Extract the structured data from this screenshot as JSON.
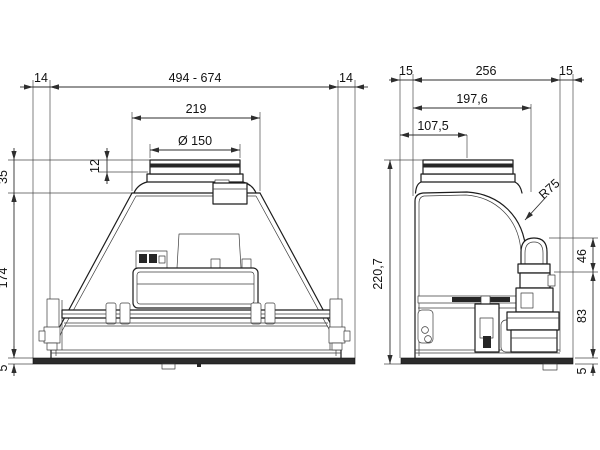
{
  "drawing": {
    "type": "technical-dimension-drawing",
    "views": {
      "front_view": {
        "dim_flange_overhang_left": "14",
        "dim_width_range": "494 - 674",
        "dim_flange_overhang_right": "14",
        "dim_top_plate_width": "219",
        "dim_duct_diameter": "Ø 150",
        "dim_collar_ring_height": "12",
        "dim_collar_height_above_top": "35",
        "dim_body_height": "174",
        "dim_flange_thickness": "5"
      },
      "side_view": {
        "dim_flange_overhang_front": "15",
        "dim_depth": "256",
        "dim_flange_overhang_rear": "15",
        "dim_body_depth": "197,6",
        "dim_duct_center_offset": "107,5",
        "dim_corner_radius": "R75",
        "dim_total_height": "220,7",
        "dim_bracket_upper_height": "46",
        "dim_bracket_lower_height": "83",
        "dim_flange_thickness": "5"
      }
    },
    "colors": {
      "line": "#1c1c1c",
      "dim_line": "#2e2e2e",
      "dark_fill": "#262626",
      "background": "#ffffff"
    }
  }
}
